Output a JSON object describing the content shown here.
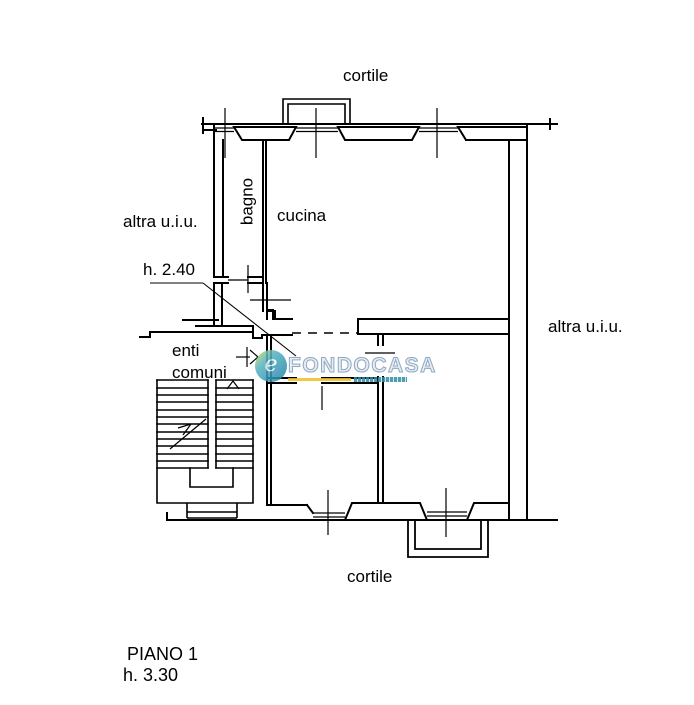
{
  "page": {
    "width": 694,
    "height": 705,
    "background": "#ffffff"
  },
  "labels": {
    "cortile_top": "cortile",
    "cortile_bottom": "cortile",
    "altra_uiu_left": "altra u.i.u.",
    "altra_uiu_right": "altra u.i.u.",
    "bagno": "bagno",
    "cucina": "cucina",
    "ceiling_height_note": "h. 2.40",
    "enti_comuni": "enti\ncomuni"
  },
  "floor_info": {
    "floor_label": "PIANO 1",
    "floor_height": "h. 3.30"
  },
  "watermark": {
    "brand": "FONDOCASA",
    "monogram": "e"
  },
  "colors": {
    "line": "#000000",
    "text": "#000000",
    "watermark_teal": "#2e8fa3",
    "watermark_yellow": "#f0c01d",
    "watermark_letters": "#e4eaf1",
    "watermark_outline": "#7d9cb8"
  }
}
